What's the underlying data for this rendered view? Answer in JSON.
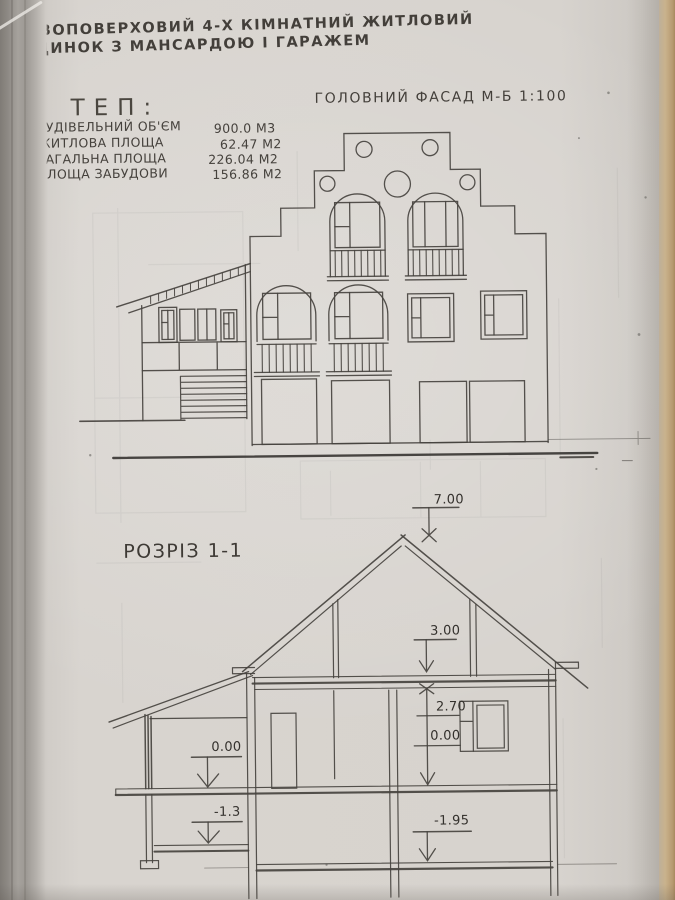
{
  "page": {
    "title_line1": "ВОПОВЕРХОВИЙ 4-Х КІМНАТНИЙ ЖИТЛОВИЙ",
    "title_line2": "ДИНОК З МАНСАРДОЮ І ГАРАЖЕМ"
  },
  "tep": {
    "heading": "ТЕП:",
    "rows": [
      {
        "label": "БУДІВЕЛЬНИЙ ОБ'ЄМ",
        "value": "900.0 М3"
      },
      {
        "label": "ЖИТЛОВА ПЛОЩА",
        "value": "62.47 М2"
      },
      {
        "label": "ЗАГАЛЬНА ПЛОЩА",
        "value": "226.04 М2"
      },
      {
        "label": "ПЛОЩА ЗАБУДОВИ",
        "value": "156.86 М2"
      }
    ]
  },
  "facade": {
    "title": "ГОЛОВНИЙ ФАСАД М-Б 1:100"
  },
  "section": {
    "title": "РОЗРІЗ 1-1",
    "marks": {
      "ridge": "7.00",
      "attic_floor": "3.00",
      "ceiling": "2.70",
      "zero_right": "0.00",
      "zero_left": "0.00",
      "terrace": "-1.3",
      "basement": "-1.95"
    }
  },
  "colors": {
    "ink": "#46433f",
    "paper": "#d7d3ce",
    "book_edge": "#c9b28c"
  }
}
